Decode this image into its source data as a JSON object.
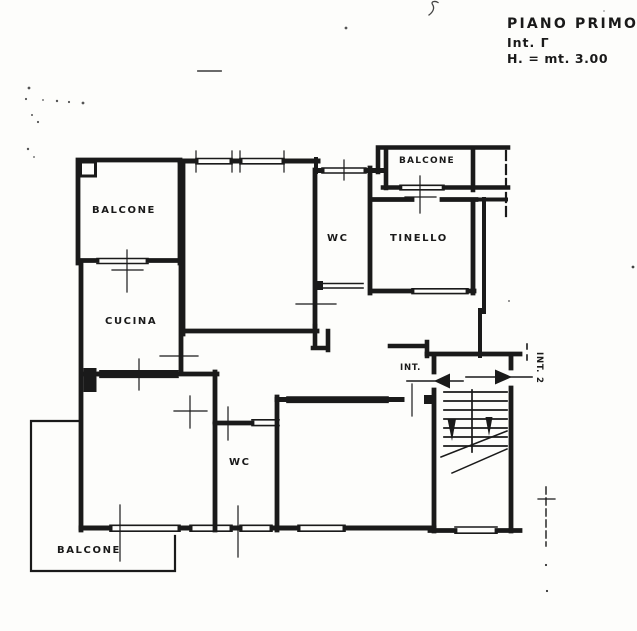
{
  "titleBlock": {
    "floor": "PIANO PRIMO",
    "interno": "Int. Γ",
    "height": "H. = mt. 3.00"
  },
  "rooms": {
    "balconeTopLeft": "BALCONE",
    "balconeTopRight": "BALCONE",
    "wcTop": "WC",
    "tinello": "TINELLO",
    "cucina": "CUCINA",
    "wcBottom": "WC",
    "balconeBottom": "BALCONE",
    "entranceLeft": "INT.",
    "entranceRight": "INT. 2"
  },
  "colors": {
    "ink": "#1a1a1a",
    "paper": "#fdfdfb"
  }
}
